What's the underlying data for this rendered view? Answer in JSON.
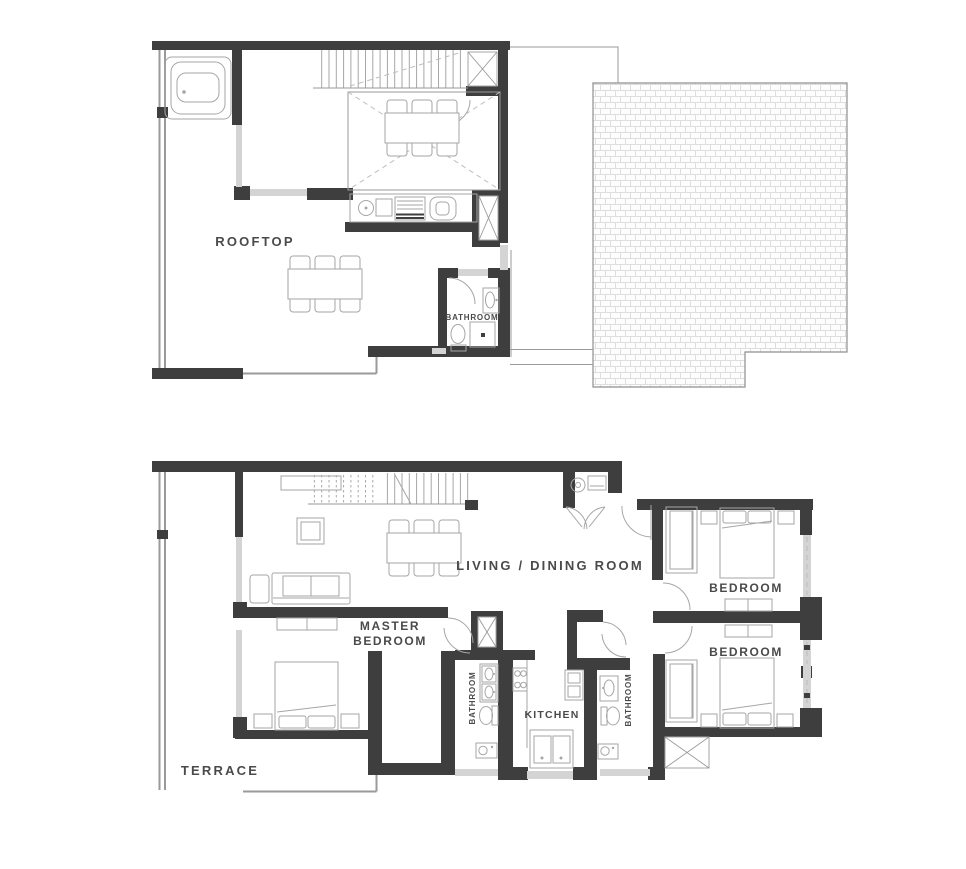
{
  "colors": {
    "wall": "#3e3e3e",
    "line": "#9a9a9a",
    "furn": "#a6a6a6",
    "window": "#d4d4d4",
    "dash": "#bdbdbd",
    "text": "#4a4a4a",
    "brick": "#dedede",
    "brickBorder": "#8f8f8f",
    "bg": "#ffffff"
  },
  "icons": {
    "bathtub-icon": "rounded-rect-tub",
    "stairs-icon": "parallel-treads",
    "skylight-icon": "rect-with-dashed-x",
    "dining-table-icon": "table-with-6-chairs",
    "sofa-icon": "rect-with-cushions",
    "coffee-table-icon": "double-square",
    "bed-icon": "rect-with-pillows",
    "closet-icon": "double-rect-with-rod",
    "toilet-icon": "ellipse-with-tank",
    "sink-icon": "rect-with-oval",
    "washer-icon": "rect-with-drum-circle",
    "stove-icon": "rect-with-4-burners",
    "fridge-icon": "rect-with-shelves",
    "door-swing-icon": "quarter-arc",
    "shaft-icon": "box-with-x",
    "roof-icon": "brick-hatch"
  },
  "floor_plans": {
    "upper": {
      "name": "rooftop-level",
      "rooms": [
        {
          "name": "rooftop",
          "label": "ROOFTOP"
        },
        {
          "name": "bathroom",
          "label": "BATHROOM"
        }
      ]
    },
    "lower": {
      "name": "main-level",
      "rooms": [
        {
          "name": "living-dining-room",
          "label": "LIVING / DINING ROOM"
        },
        {
          "name": "master-bedroom",
          "label_line1": "MASTER",
          "label_line2": "BEDROOM"
        },
        {
          "name": "bedroom-top",
          "label": "BEDROOM"
        },
        {
          "name": "bedroom-bottom",
          "label": "BEDROOM"
        },
        {
          "name": "kitchen",
          "label": "KITCHEN"
        },
        {
          "name": "bathroom-left",
          "label": "BATHROOM"
        },
        {
          "name": "bathroom-right",
          "label": "BATHROOM"
        },
        {
          "name": "terrace",
          "label": "TERRACE"
        }
      ]
    }
  }
}
